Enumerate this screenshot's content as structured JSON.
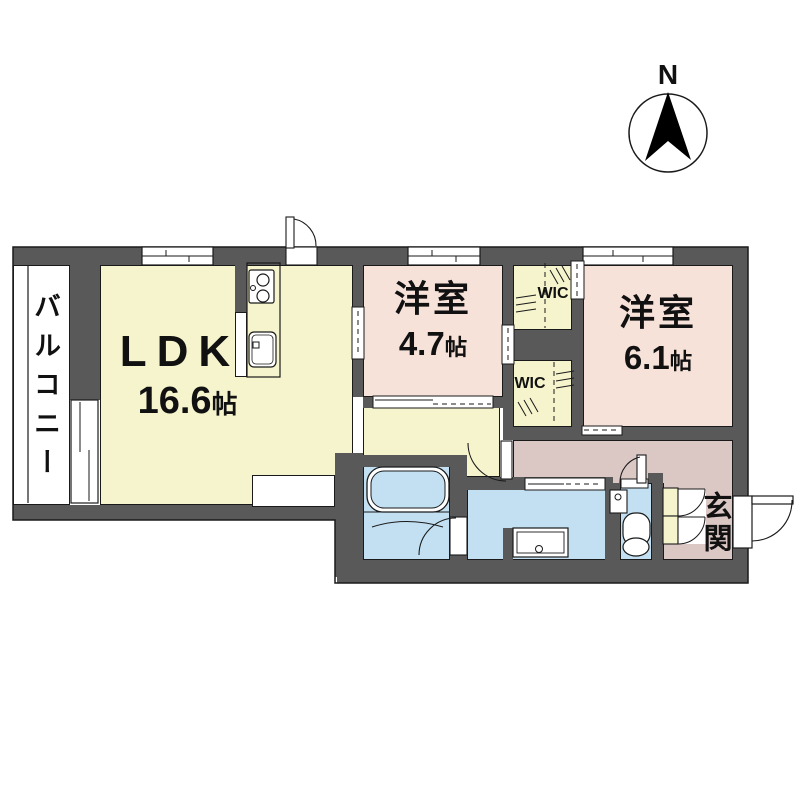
{
  "compass": {
    "label": "N"
  },
  "balcony": {
    "label": "バルコニー"
  },
  "rooms": {
    "ldk": {
      "name": "LDK",
      "area": "16.6",
      "unit": "帖"
    },
    "west47": {
      "name": "洋室",
      "area": "4.7",
      "unit": "帖"
    },
    "west61": {
      "name": "洋室",
      "area": "6.1",
      "unit": "帖"
    },
    "wic1": {
      "label": "WIC"
    },
    "wic2": {
      "label": "WIC"
    },
    "entrance": {
      "label": "玄関"
    }
  },
  "colors": {
    "wall": "#595959",
    "ldk_fill": "#f6f4cd",
    "western_room_fill": "#f7e2d9",
    "hall_entrance_fill": "#dbc8c5",
    "wet_area_fill": "#c2e0f2",
    "balcony_fill": "#ffffff",
    "line": "#1a1a1a"
  }
}
